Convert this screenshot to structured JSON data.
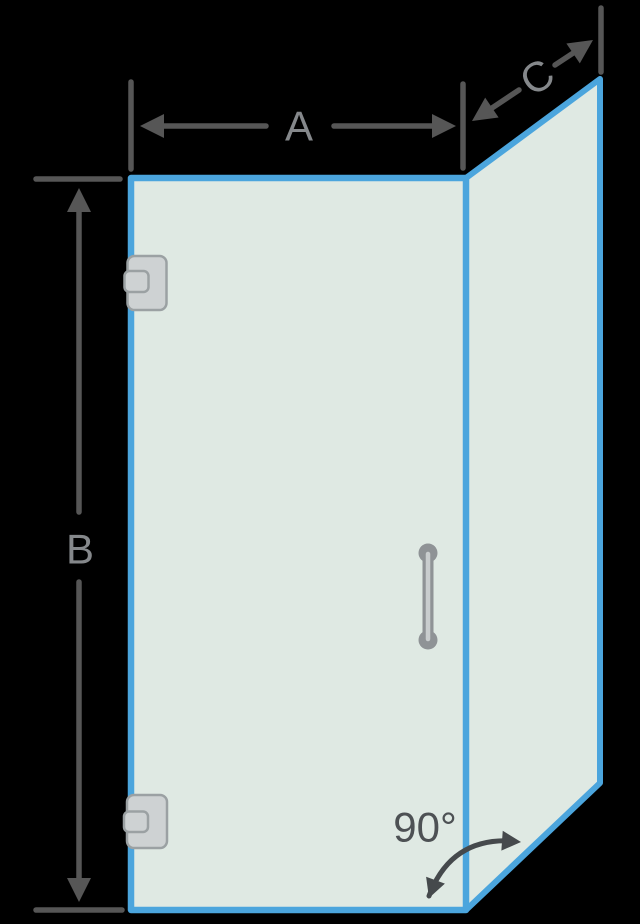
{
  "diagram": {
    "labels": {
      "width": "A",
      "height": "B",
      "return_width": "C",
      "angle": "90°"
    },
    "colors": {
      "background": "#000000",
      "glass_fill": "#dfe9e3",
      "glass_edge_blue": "#4ba5dd",
      "dimension_line_gray": "#565656",
      "dimension_label_gray": "#85888b",
      "angle_text_gray": "#4d5154",
      "angle_arrow_gray": "#45494c",
      "hardware_fill_gray": "#ced2d3",
      "hardware_border_gray": "#9ba1a3",
      "handle_dark_gray": "#8f9396",
      "handle_light_gray": "#c9cdce"
    }
  }
}
